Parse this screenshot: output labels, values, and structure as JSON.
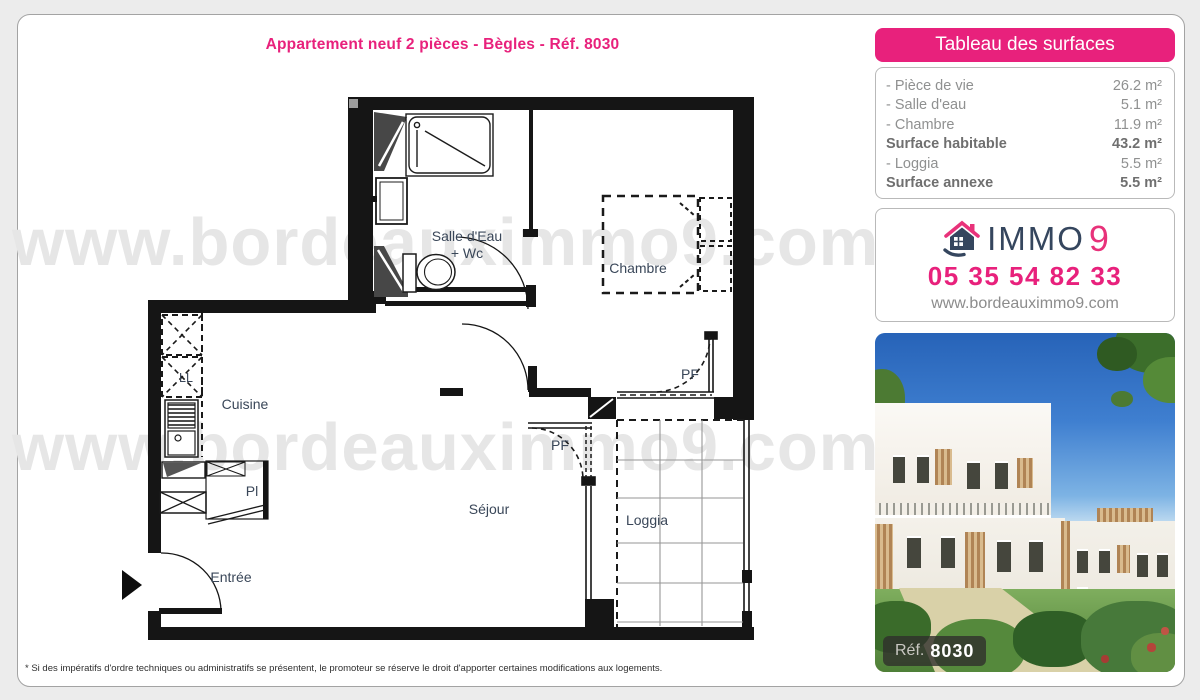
{
  "page": {
    "title": "Appartement neuf 2 pièces - Bègles - Réf. 8030",
    "footnote": "* Si des impératifs d'ordre techniques ou administratifs se présentent, le promoteur se réserve le droit d'apporter certaines modifications aux logements."
  },
  "watermark": {
    "text": "www.bordeauximmo9.com"
  },
  "surfaces": {
    "header": "Tableau des surfaces",
    "rows": [
      {
        "label": "- Pièce de vie",
        "value": "26.2 m²"
      },
      {
        "label": "- Salle d'eau",
        "value": "5.1 m²"
      },
      {
        "label": "- Chambre",
        "value": "11.9 m²"
      },
      {
        "label": "Surface habitable",
        "value": "43.2 m²"
      },
      {
        "label": "- Loggia",
        "value": "5.5 m²"
      },
      {
        "label": "Surface annexe",
        "value": "5.5 m²"
      }
    ]
  },
  "agency": {
    "brand_immo": "IMMO",
    "brand_nine": "9",
    "phone": "05 35 54 82 33",
    "website": "www.bordeauximmo9.com"
  },
  "photo": {
    "ref_label": "Réf.",
    "ref_number": "8030"
  },
  "plan": {
    "labels": {
      "salle_deau_1": "Salle d'Eau",
      "salle_deau_2": "+ Wc",
      "chambre": "Chambre",
      "cuisine": "Cuisine",
      "sejour": "Séjour",
      "entree": "Entrée",
      "loggia": "Loggia",
      "pf_left": "PF",
      "pf_right": "PF",
      "ll": "LL",
      "pl": "Pl"
    }
  },
  "colors": {
    "pink": "#e8217c",
    "navy": "#35465e",
    "wall": "#151515",
    "watermark": "#e6e6e6"
  }
}
